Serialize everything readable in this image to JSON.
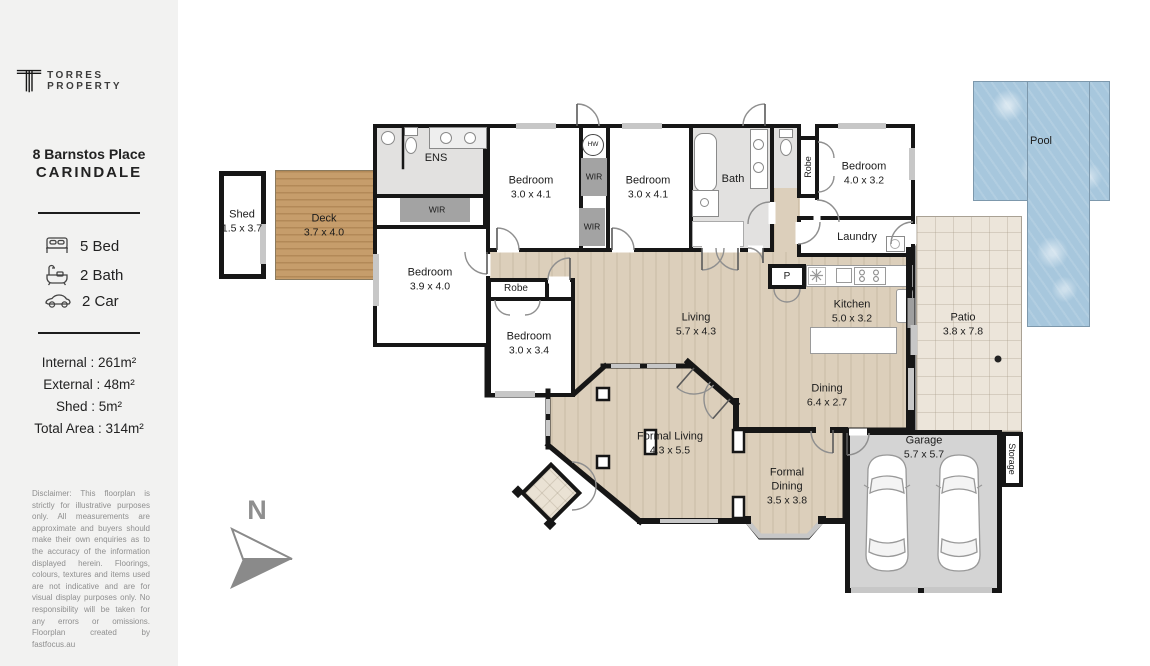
{
  "sidebar": {
    "brand": "TORRES PROPERTY",
    "address_line1": "8 Barnstos Place",
    "address_line2": "CARINDALE",
    "features": {
      "bed": "5 Bed",
      "bath": "2 Bath",
      "car": "2 Car"
    },
    "areas": {
      "internal": "Internal : 261m²",
      "external": "External : 48m²",
      "shed": "Shed : 5m²",
      "total": "Total Area : 314m²"
    },
    "disclaimer": "Disclaimer: This floorplan is strictly for illustrative purposes only. All measurements are approximate and buyers should make their own enquiries as to the accuracy of the information displayed herein. Floorings, colours, textures and items used are not indicative and are for visual display purposes only. No responsibility will be taken for any errors or omissions. Floorplan created by fastfocus.au"
  },
  "compass": {
    "north": "N"
  },
  "rooms": {
    "shed": {
      "name": "Shed",
      "dims": "1.5 x 3.7"
    },
    "deck": {
      "name": "Deck",
      "dims": "3.7 x 4.0"
    },
    "ens": {
      "name": "ENS"
    },
    "wir_ens": {
      "name": "WIR"
    },
    "bedroom_39": {
      "name": "Bedroom",
      "dims": "3.9 x 4.0"
    },
    "bedroom_30a": {
      "name": "Bedroom",
      "dims": "3.0 x 4.1"
    },
    "bedroom_30b": {
      "name": "Bedroom",
      "dims": "3.0 x 4.1"
    },
    "wir1": {
      "name": "WIR"
    },
    "wir2": {
      "name": "WIR"
    },
    "hw": {
      "name": "HW"
    },
    "bath": {
      "name": "Bath"
    },
    "robe_hall": {
      "name": "Robe"
    },
    "bedroom_40": {
      "name": "Bedroom",
      "dims": "4.0 x 3.2"
    },
    "laundry": {
      "name": "Laundry"
    },
    "pantry": {
      "name": "P"
    },
    "kitchen": {
      "name": "Kitchen",
      "dims": "5.0 x 3.2"
    },
    "living": {
      "name": "Living",
      "dims": "5.7 x 4.3"
    },
    "dining": {
      "name": "Dining",
      "dims": "6.4 x 2.7"
    },
    "formal_living": {
      "name": "Formal Living",
      "dims": "4.3 x 5.5"
    },
    "formal_dining": {
      "name": "Formal\nDining",
      "dims": "3.5 x 3.8"
    },
    "bedroom_34": {
      "name": "Bedroom",
      "dims": "3.0 x 3.4"
    },
    "robe_bed": {
      "name": "Robe"
    },
    "garage": {
      "name": "Garage",
      "dims": "5.7 x 5.7"
    },
    "storage": {
      "name": "Storage"
    },
    "patio": {
      "name": "Patio",
      "dims": "3.8 x 7.8"
    },
    "pool": {
      "name": "Pool"
    }
  },
  "colors": {
    "wall": "#161616",
    "wood_floor": "#dccfbb",
    "deck_wood": "#c69d6b",
    "wet_area_gray": "#e2e1e0",
    "closet_gray": "#a3a3a3",
    "garage_gray": "#d4d4d4",
    "patio_tile": "#ece5da",
    "pool_blue": "#a7c7dd",
    "sidebar_bg": "#f2f2f1"
  }
}
